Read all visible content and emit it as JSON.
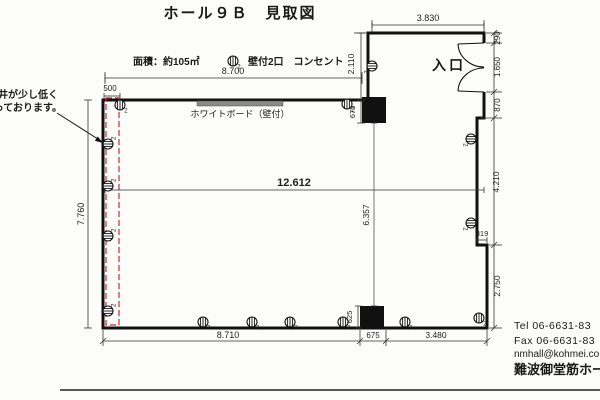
{
  "title": "ホール９Ｂ　見取図",
  "legend": {
    "area": "面積：約105㎡",
    "outlet_label": "壁付2口　コンセント",
    "outlet_count": "2"
  },
  "labels": {
    "entrance": "入口",
    "whiteboard": "ホワイトボード（壁付）",
    "note_line1": "天井が少し低く",
    "note_line2": "っております。"
  },
  "dimensions": {
    "top_main": "8.700",
    "strip_width": "500",
    "left_height": "7.760",
    "total_width": "12.612",
    "mid_height": "6.357",
    "corridor": "2.110",
    "top_pillar": "675",
    "top_right": "3.830",
    "right_290": "290",
    "door": "1.650",
    "right_870": "870",
    "right_mid": "4.210",
    "right_319": "319",
    "right_low": "2.750",
    "bottom_pillar": "625",
    "bottom_left": "8.710",
    "bottom_mid": "675",
    "bottom_right": "3.480"
  },
  "contact": {
    "tel": "Tel  06-6631-83",
    "fax": "Fax 06-6631-83",
    "email": "nmhall@kohmei.co",
    "hall_name": "難波御堂筋ホール"
  },
  "colors": {
    "wall": "#111111",
    "red_dashed": "#cc2a2a",
    "whiteboard": "#8a8a8a",
    "dim_line": "#333333"
  },
  "outlets": [
    {
      "x": 120,
      "y": 105,
      "r": 0
    },
    {
      "x": 347,
      "y": 104,
      "r": 0
    },
    {
      "x": 372,
      "y": 66,
      "r": 90
    },
    {
      "x": 471,
      "y": 139,
      "r": 90
    },
    {
      "x": 471,
      "y": 223,
      "r": 90
    },
    {
      "x": 479,
      "y": 318,
      "r": 0
    },
    {
      "x": 405,
      "y": 322,
      "r": 0
    },
    {
      "x": 343,
      "y": 322,
      "r": 0
    },
    {
      "x": 290,
      "y": 322,
      "r": 0
    },
    {
      "x": 252,
      "y": 322,
      "r": 0
    },
    {
      "x": 203,
      "y": 322,
      "r": 0
    },
    {
      "x": 108,
      "y": 311,
      "r": -90
    },
    {
      "x": 108,
      "y": 236,
      "r": -90
    },
    {
      "x": 108,
      "y": 186,
      "r": -90
    },
    {
      "x": 108,
      "y": 144,
      "r": -90
    }
  ]
}
